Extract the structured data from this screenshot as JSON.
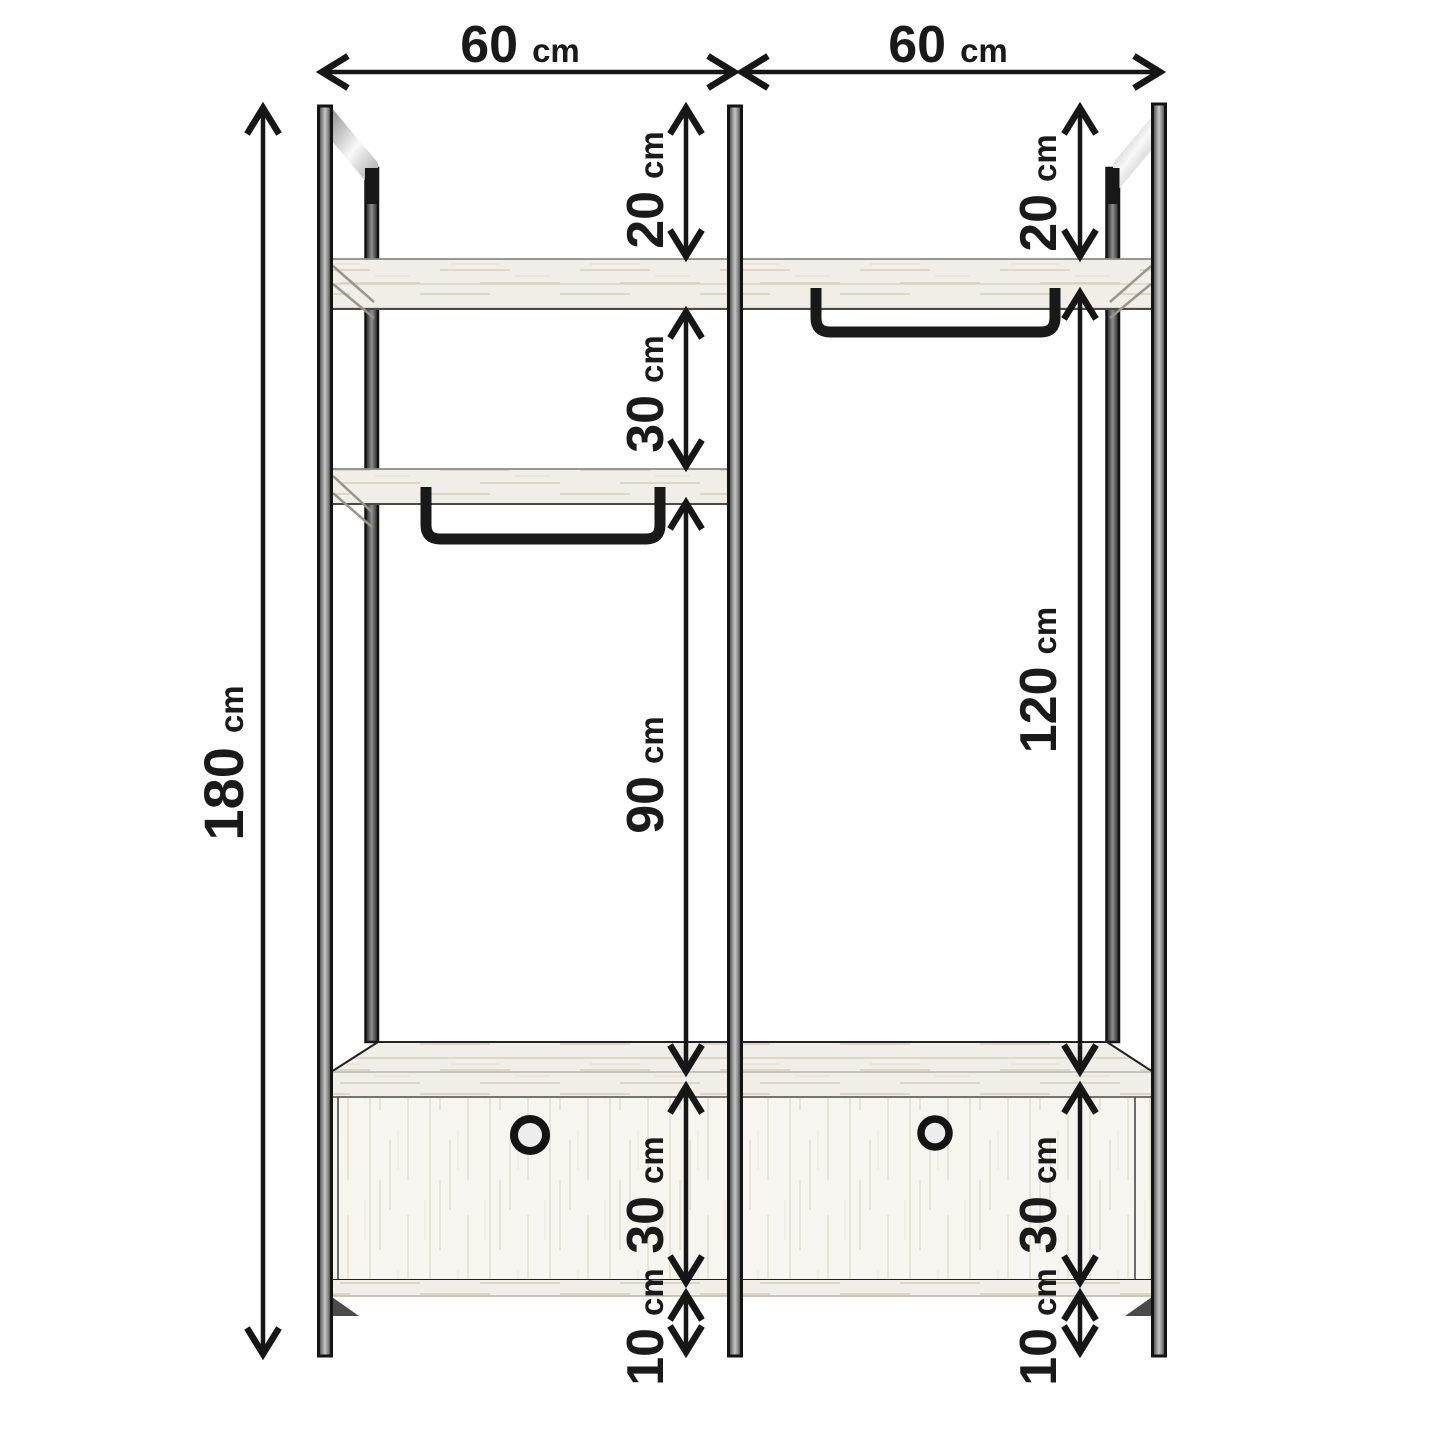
{
  "page": {
    "background": "#ffffff",
    "description": "Dimension diagram of a two-bay open wardrobe with shelves, hanging rails and drawers"
  },
  "dims": {
    "total_height": {
      "value": "180",
      "unit": "cm"
    },
    "bay_left_width": {
      "value": "60",
      "unit": "cm"
    },
    "bay_right_width": {
      "value": "60",
      "unit": "cm"
    },
    "left_top_clearance": {
      "value": "20",
      "unit": "cm"
    },
    "left_shelf_spacing": {
      "value": "30",
      "unit": "cm"
    },
    "left_hanging_height": {
      "value": "90",
      "unit": "cm"
    },
    "left_drawer_height": {
      "value": "30",
      "unit": "cm"
    },
    "left_base_clearance": {
      "value": "10",
      "unit": "cm"
    },
    "right_top_clearance": {
      "value": "20",
      "unit": "cm"
    },
    "right_hanging_height": {
      "value": "120",
      "unit": "cm"
    },
    "right_drawer_height": {
      "value": "30",
      "unit": "cm"
    },
    "right_base_clearance": {
      "value": "10",
      "unit": "cm"
    }
  },
  "colors": {
    "line": "#161616",
    "text": "#1a1a1a",
    "wood_light": "#f1eee7",
    "wood_grain": "#ddd6c9",
    "metal": "#c9c9c9"
  }
}
